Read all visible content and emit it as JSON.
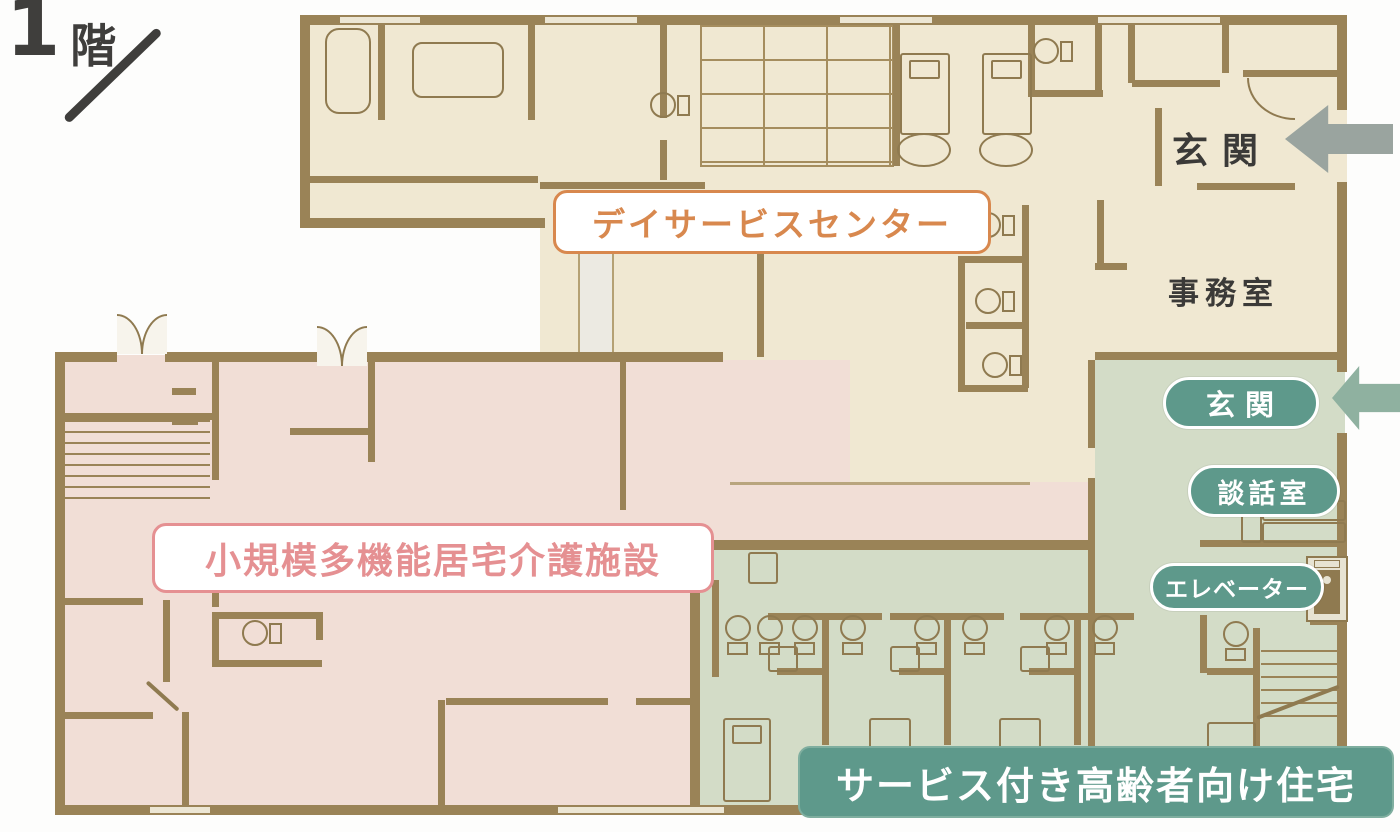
{
  "title": {
    "floor_number": "1",
    "floor_suffix": "階"
  },
  "zone_labels": {
    "day_service": "デイサービスセンター",
    "small_care": "小規模多機能居宅介護施設",
    "senior_housing": "サービス付き高齢者向け住宅"
  },
  "room_labels": {
    "entrance_main": "玄関",
    "office": "事務室",
    "entrance_senior": "玄関",
    "lounge": "談話室",
    "elevator": "エレベーター"
  },
  "colors": {
    "floor_day_service": "#f0e8d2",
    "floor_tatami": "#eee5c6",
    "floor_small_care": "#f1ded6",
    "floor_senior": "#d3dcc7",
    "wall": "#9a8357",
    "furniture_line": "#8f7a50",
    "label_orange": "#d8884e",
    "label_pink": "#e59092",
    "label_green": "#5e998b",
    "text_dark": "#3b3a38",
    "arrow_gray": "#9aa49f",
    "arrow_green": "#8fb1a0"
  }
}
